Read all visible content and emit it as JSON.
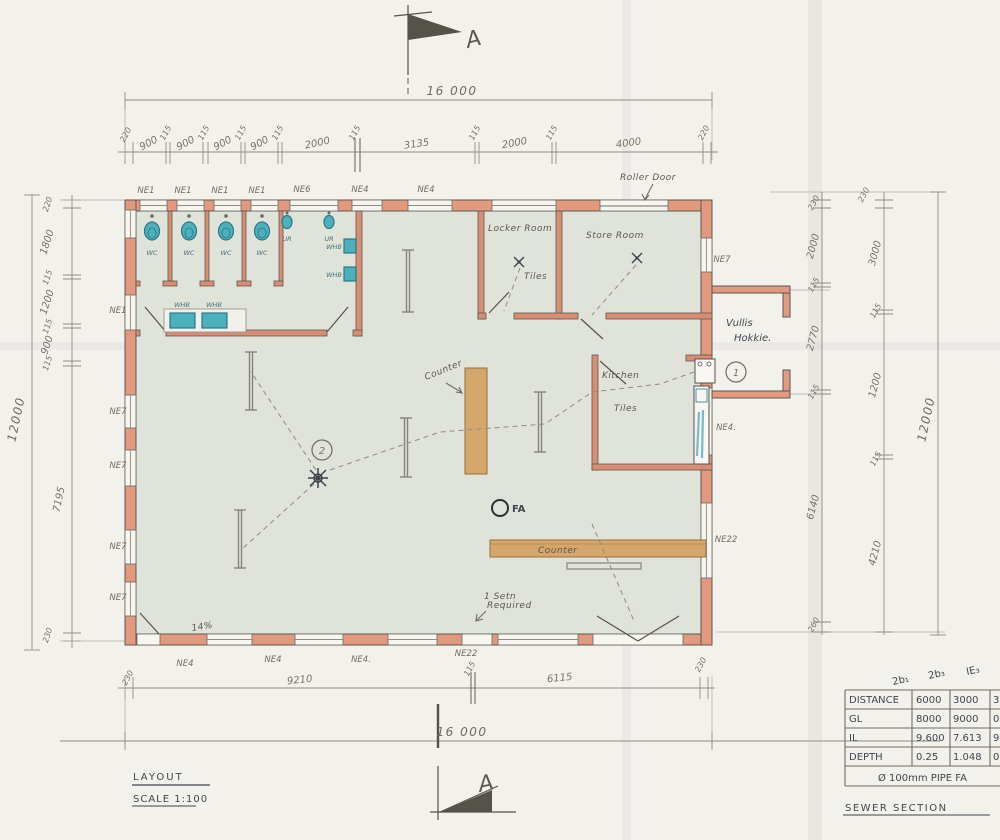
{
  "drawing": {
    "title": "LAYOUT",
    "scale": "SCALE 1:100",
    "sewer_title": "SEWER SECTION",
    "section_marker": "A"
  },
  "dims": {
    "top": {
      "overall": "16 000",
      "segs": [
        "220",
        "900",
        "115",
        "900",
        "115",
        "900",
        "115",
        "900",
        "115",
        "2000",
        "115",
        "3135",
        "115",
        "2000",
        "115",
        "4000",
        "220"
      ]
    },
    "bottom": {
      "overall": "16 000",
      "segs": [
        "230",
        "9210",
        "115",
        "6115",
        "230"
      ]
    },
    "left": {
      "overall": "12000",
      "segs": [
        "220",
        "1800",
        "115",
        "1200",
        "115",
        "900",
        "115",
        "7195",
        "230"
      ]
    },
    "right": {
      "overall": "12000",
      "inner": [
        "230",
        "2000",
        "115",
        "2770",
        "115",
        "6140",
        "260"
      ],
      "mid": [
        "230",
        "3000",
        "115",
        "1200",
        "115",
        "4210"
      ]
    }
  },
  "windows": {
    "top": [
      "NE1",
      "NE1",
      "NE1",
      "NE1",
      "NE6",
      "NE4",
      "NE4"
    ],
    "left": [
      "NE1",
      "NE7",
      "NE7",
      "NE7",
      "NE7"
    ],
    "right": [
      "NE7",
      "NE4.",
      "NE22"
    ],
    "bottom": [
      "NE4",
      "NE4",
      "NE4.",
      "NE22"
    ]
  },
  "fixtures": {
    "wc": "WC",
    "ur": "UR",
    "whb": "WHB"
  },
  "rooms": {
    "locker": "Locker Room",
    "locker_floor": "Tiles",
    "store": "Store Room",
    "kitchen": "Kitchen",
    "kitchen_floor": "Tiles",
    "refuse1": "Vullis",
    "refuse2": "Hokkie.",
    "roller_door": "Roller Door",
    "counter1": "Counter",
    "counter2": "Counter",
    "slope": "14%",
    "note1": "1 Setn",
    "note2": "Required",
    "fire_alarm": "FA",
    "ie_point1": "1",
    "ie_point2": "2"
  },
  "sewer_table": {
    "headers": [
      "2b₁",
      "2b₃",
      "IE₃"
    ],
    "rows": [
      {
        "label": "DISTANCE",
        "values": [
          "6000",
          "3000",
          "3"
        ]
      },
      {
        "label": "GL",
        "values": [
          "8000",
          "9000",
          "0"
        ]
      },
      {
        "label": "IL",
        "values": [
          "9.600",
          "7.613",
          "9"
        ]
      },
      {
        "label": "DEPTH",
        "values": [
          "0.25",
          "1.048",
          "0"
        ]
      }
    ],
    "footer": "Ø 100mm  PIPE  FA"
  }
}
